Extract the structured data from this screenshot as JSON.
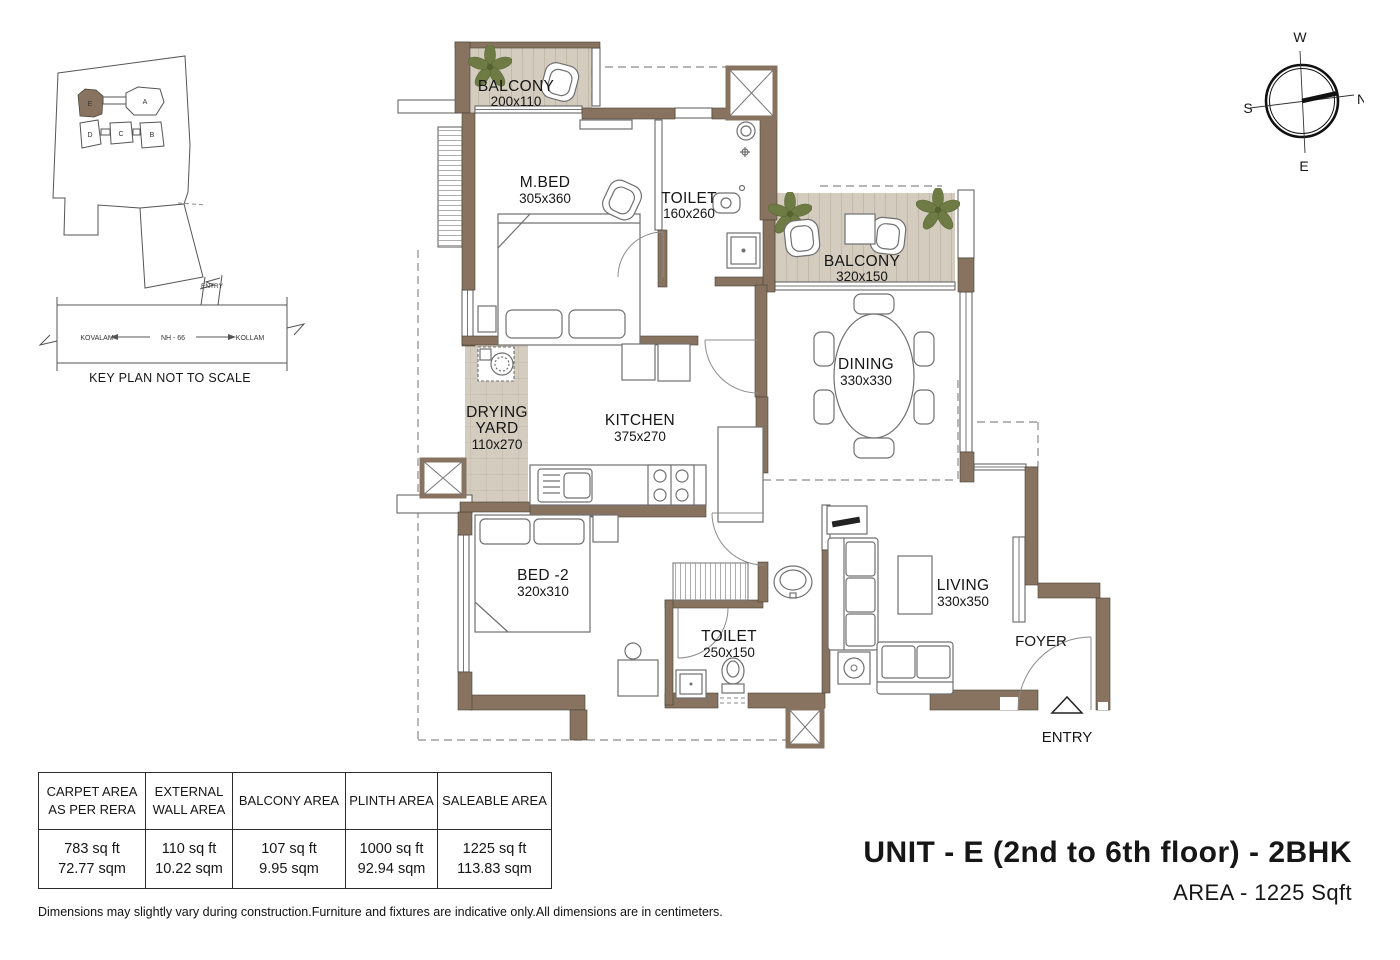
{
  "key_plan": {
    "caption": "KEY PLAN NOT TO SCALE",
    "entry_label": "ENTRY",
    "road": {
      "left_city": "KOVALAM",
      "highway": "NH - 66",
      "right_city": "KOLLAM"
    },
    "buildings": {
      "a": "A",
      "b": "B",
      "c": "C",
      "d": "D",
      "e": "E"
    }
  },
  "compass": {
    "top": "W",
    "right": "N",
    "bottom": "E",
    "left": "S"
  },
  "plan": {
    "rooms": {
      "balcony_top": {
        "name": "BALCONY",
        "dims": "200x110"
      },
      "master_bed": {
        "name": "M.BED",
        "dims": "305x360"
      },
      "toilet_top": {
        "name": "TOILET",
        "dims": "160x260"
      },
      "balcony_right": {
        "name": "BALCONY",
        "dims": "320x150"
      },
      "dining": {
        "name": "DINING",
        "dims": "330x330"
      },
      "drying_yard": {
        "line1": "DRYING",
        "line2": "YARD",
        "dims": "110x270"
      },
      "kitchen": {
        "name": "KITCHEN",
        "dims": "375x270"
      },
      "bed2": {
        "name": "BED -2",
        "dims": "320x310"
      },
      "toilet_bottom": {
        "name": "TOILET",
        "dims": "250x150"
      },
      "living": {
        "name": "LIVING",
        "dims": "330x350"
      },
      "foyer": {
        "name": "FOYER"
      },
      "entry": {
        "name": "ENTRY"
      }
    }
  },
  "area_table": {
    "columns": [
      {
        "header1": "CARPET AREA",
        "header2": "AS PER RERA",
        "sqft": "783 sq ft",
        "sqm": "72.77 sqm"
      },
      {
        "header1": "EXTERNAL",
        "header2": "WALL AREA",
        "sqft": "110 sq ft",
        "sqm": "10.22 sqm"
      },
      {
        "header1": "BALCONY AREA",
        "header2": "",
        "sqft": "107 sq ft",
        "sqm": "9.95 sqm"
      },
      {
        "header1": "PLINTH AREA",
        "header2": "",
        "sqft": "1000 sq ft",
        "sqm": "92.94 sqm"
      },
      {
        "header1": "SALEABLE AREA",
        "header2": "",
        "sqft": "1225 sq ft",
        "sqm": "113.83 sqm"
      }
    ]
  },
  "title": {
    "line1": "UNIT - E (2nd to 6th floor) - 2BHK",
    "line2": "AREA - 1225 Sqft"
  },
  "footnote": "Dimensions may slightly vary during construction.Furniture and fixtures are indicative only.All dimensions are in centimeters.",
  "colors": {
    "wall": "#87735F",
    "balcony_floor": "#D3CCBF",
    "floor_line": "#C2B9A9",
    "plant": "#6E7B45",
    "ink": "#161616",
    "line": "#5A5A5A",
    "dash": "#8A8A8A",
    "furniture": "#707070"
  }
}
